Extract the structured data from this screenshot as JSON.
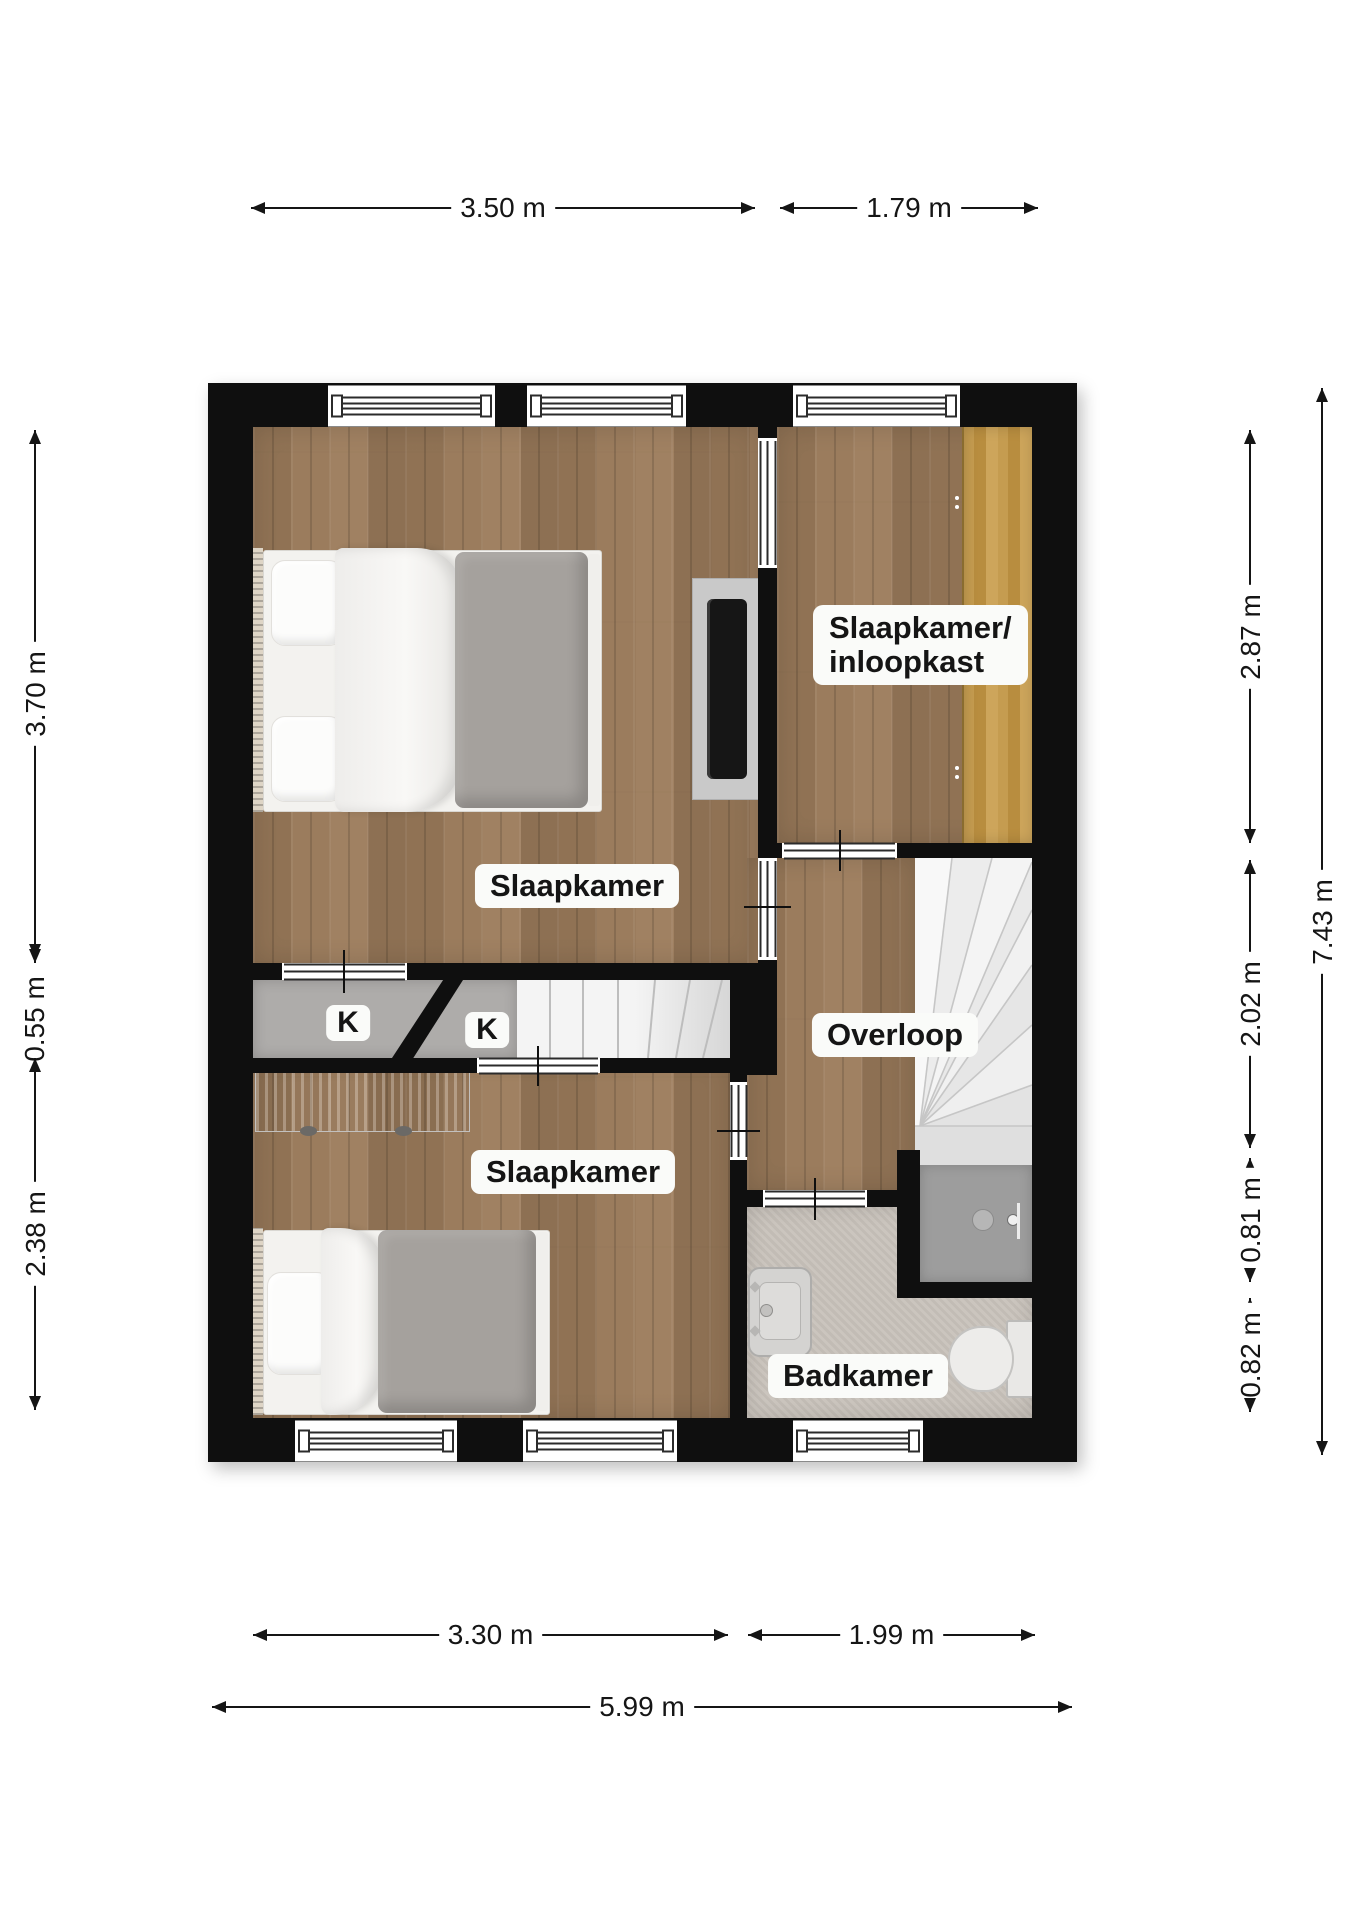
{
  "plan": {
    "rooms": {
      "bedroom_top": {
        "label": "Slaapkamer"
      },
      "bedroom_bottom": {
        "label": "Slaapkamer"
      },
      "walkin_closet": {
        "label_line1": "Slaapkamer/",
        "label_line2": "inloopkast"
      },
      "landing": {
        "label": "Overloop"
      },
      "bathroom": {
        "label": "Badkamer"
      },
      "closet_left": {
        "label": "K"
      },
      "closet_right": {
        "label": "K"
      }
    },
    "dimensions": {
      "top": {
        "width_bedroom": "3.50 m",
        "width_closet_room": "1.79 m"
      },
      "bottom": {
        "width_bedroom": "3.30 m",
        "width_bathroom": "1.99 m",
        "total_width": "5.99 m"
      },
      "left": {
        "bedroom_top_depth": "3.70 m",
        "closet_row_depth": "0.55 m",
        "bedroom_bottom_depth": "2.38 m"
      },
      "right": {
        "closet_room_depth": "2.87 m",
        "landing_depth": "2.02 m",
        "shower_depth": "0.81 m",
        "toilet_depth": "0.82 m",
        "total_height": "7.43 m"
      }
    },
    "fixtures": [
      "double-bed",
      "tv",
      "wardrobe",
      "dresser",
      "single-bed",
      "straight-stairs",
      "winder-stairs",
      "sink",
      "toilet",
      "shower"
    ],
    "colors": {
      "wall": "#0f0f0f",
      "wood_floor": "#97795b",
      "closet_wood": "#c0974e",
      "closet_gray": "#aeacaa",
      "bathroom_floor": "#c8c2bb",
      "shower": "#9d9d9d",
      "stairs": "#f3f3f3",
      "label_bg": "#fafbf9",
      "dim_text": "#151515"
    }
  }
}
